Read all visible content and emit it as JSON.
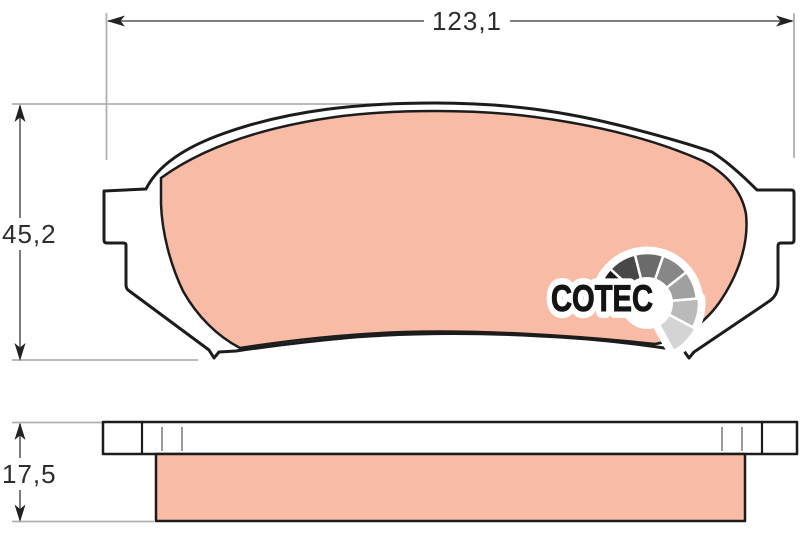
{
  "diagram": {
    "subject": "brake-pad-technical-drawing",
    "dimensions": {
      "width": {
        "label": "123,1"
      },
      "height": {
        "label": "45,2"
      },
      "thickness": {
        "label": "17,5"
      }
    },
    "logo": {
      "text": "COTEC",
      "fan_colors": [
        "#191919",
        "#484848",
        "#6b6b6b",
        "#878787",
        "#a0a0a0",
        "#bababa",
        "#d4d4d4"
      ]
    },
    "colors": {
      "friction_material": "#f8bba6",
      "outline": "#1c1c1c",
      "dimension_line": "#6e6e6e",
      "extension_line": "#b0b0b0",
      "dimension_text": "#2d2d2d",
      "background": "#ffffff"
    }
  }
}
